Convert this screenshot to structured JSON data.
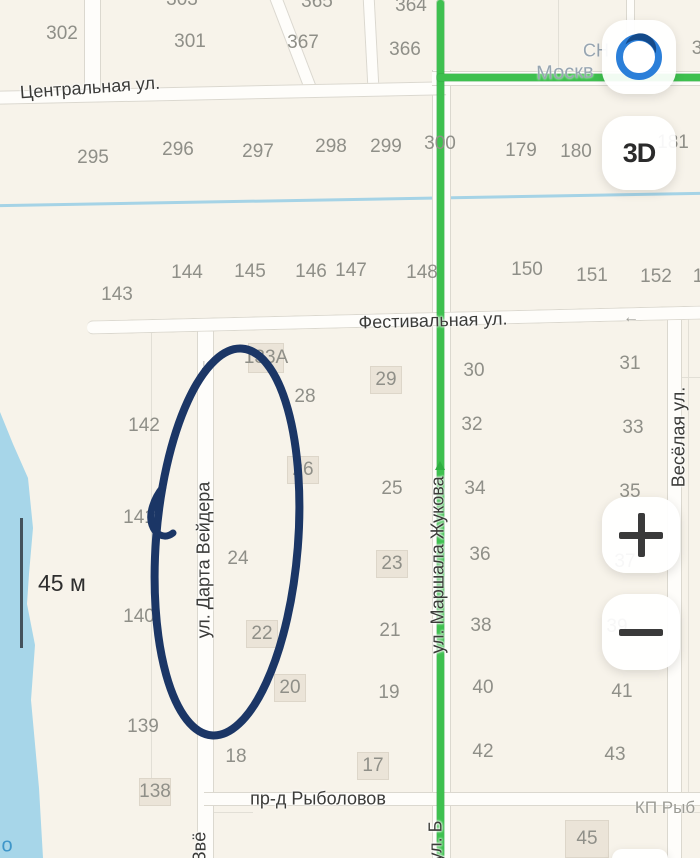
{
  "app": "map-view",
  "scale": {
    "label": "45 м"
  },
  "controls": {
    "compass_icon": "compass-location",
    "threeD_label": "3D",
    "zoom_in": "+",
    "zoom_out": "−"
  },
  "colors": {
    "map_bg": "#f7f3ea",
    "water": "#a7d6e9",
    "route_green": "#3ec04f",
    "annotation_navy": "#1b3666",
    "compass_ring_blue": "#2b7fd9",
    "plot_text": "#8f8f88"
  },
  "map": {
    "streets": {
      "central": {
        "label": "Центральная ул."
      },
      "festival": {
        "label": "Фестивальная ул."
      },
      "rybolov": {
        "label": "пр-д Рыболовов"
      },
      "darta": {
        "label": "ул. Дарта Вейдера"
      },
      "zhukova": {
        "label": "ул. Маршала Жукова"
      },
      "veselaya": {
        "label": "Весёлая ул."
      },
      "zvezdnaya_partial": {
        "label": "Звё"
      },
      "b_partial": {
        "label": "ул. Б"
      },
      "moskva_partial": {
        "label": "Москв"
      },
      "sn_partial": {
        "label": "СН"
      },
      "kp_partial": {
        "label": "КП Рыб"
      },
      "water_letter": {
        "label": "о"
      }
    },
    "oneway_arrows": {
      "darta_down": "↓",
      "festival_left": "←"
    },
    "plots": [
      {
        "n": "303",
        "x": 182,
        "y": 0
      },
      {
        "n": "365",
        "x": 317,
        "y": 2
      },
      {
        "n": "364",
        "x": 411,
        "y": 6
      },
      {
        "n": "302",
        "x": 62,
        "y": 34
      },
      {
        "n": "301",
        "x": 190,
        "y": 42
      },
      {
        "n": "367",
        "x": 303,
        "y": 43
      },
      {
        "n": "366",
        "x": 405,
        "y": 50
      },
      {
        "n": "3",
        "x": 697,
        "y": 49
      },
      {
        "n": "295",
        "x": 93,
        "y": 158
      },
      {
        "n": "296",
        "x": 178,
        "y": 150
      },
      {
        "n": "297",
        "x": 258,
        "y": 152
      },
      {
        "n": "298",
        "x": 331,
        "y": 147
      },
      {
        "n": "299",
        "x": 386,
        "y": 147
      },
      {
        "n": "300",
        "x": 440,
        "y": 144
      },
      {
        "n": "179",
        "x": 521,
        "y": 151
      },
      {
        "n": "180",
        "x": 576,
        "y": 152
      },
      {
        "n": "181",
        "x": 673,
        "y": 143
      },
      {
        "n": "143",
        "x": 117,
        "y": 295
      },
      {
        "n": "144",
        "x": 187,
        "y": 273
      },
      {
        "n": "145",
        "x": 250,
        "y": 272
      },
      {
        "n": "146",
        "x": 311,
        "y": 272
      },
      {
        "n": "147",
        "x": 351,
        "y": 271
      },
      {
        "n": "148",
        "x": 422,
        "y": 273
      },
      {
        "n": "150",
        "x": 527,
        "y": 270
      },
      {
        "n": "151",
        "x": 592,
        "y": 276
      },
      {
        "n": "152",
        "x": 656,
        "y": 277
      },
      {
        "n": "1",
        "x": 698,
        "y": 277
      },
      {
        "n": "133А",
        "x": 266,
        "y": 358,
        "bg": true,
        "bw": 34,
        "bh": 28
      },
      {
        "n": "28",
        "x": 305,
        "y": 397
      },
      {
        "n": "29",
        "x": 386,
        "y": 380,
        "bg": true
      },
      {
        "n": "30",
        "x": 474,
        "y": 371
      },
      {
        "n": "31",
        "x": 630,
        "y": 364
      },
      {
        "n": "142",
        "x": 144,
        "y": 426
      },
      {
        "n": "32",
        "x": 472,
        "y": 425
      },
      {
        "n": "33",
        "x": 633,
        "y": 428
      },
      {
        "n": "26",
        "x": 303,
        "y": 470,
        "bg": true
      },
      {
        "n": "25",
        "x": 392,
        "y": 489
      },
      {
        "n": "34",
        "x": 475,
        "y": 489
      },
      {
        "n": "35",
        "x": 630,
        "y": 492
      },
      {
        "n": "141",
        "x": 139,
        "y": 518
      },
      {
        "n": "24",
        "x": 238,
        "y": 559
      },
      {
        "n": "23",
        "x": 392,
        "y": 564,
        "bg": true
      },
      {
        "n": "36",
        "x": 480,
        "y": 555
      },
      {
        "n": "37",
        "x": 625,
        "y": 562
      },
      {
        "n": "140",
        "x": 139,
        "y": 617
      },
      {
        "n": "22",
        "x": 262,
        "y": 634,
        "bg": true
      },
      {
        "n": "21",
        "x": 390,
        "y": 631
      },
      {
        "n": "38",
        "x": 481,
        "y": 626
      },
      {
        "n": "39",
        "x": 617,
        "y": 627
      },
      {
        "n": "20",
        "x": 290,
        "y": 688,
        "bg": true
      },
      {
        "n": "19",
        "x": 389,
        "y": 693
      },
      {
        "n": "40",
        "x": 483,
        "y": 688
      },
      {
        "n": "41",
        "x": 622,
        "y": 692
      },
      {
        "n": "139",
        "x": 143,
        "y": 727
      },
      {
        "n": "18",
        "x": 236,
        "y": 757
      },
      {
        "n": "17",
        "x": 373,
        "y": 766,
        "bg": true
      },
      {
        "n": "42",
        "x": 483,
        "y": 752
      },
      {
        "n": "43",
        "x": 615,
        "y": 755
      },
      {
        "n": "138",
        "x": 155,
        "y": 792,
        "bg": true
      },
      {
        "n": "45",
        "x": 587,
        "y": 839,
        "bg": true,
        "bw": 42,
        "bh": 36
      }
    ]
  }
}
